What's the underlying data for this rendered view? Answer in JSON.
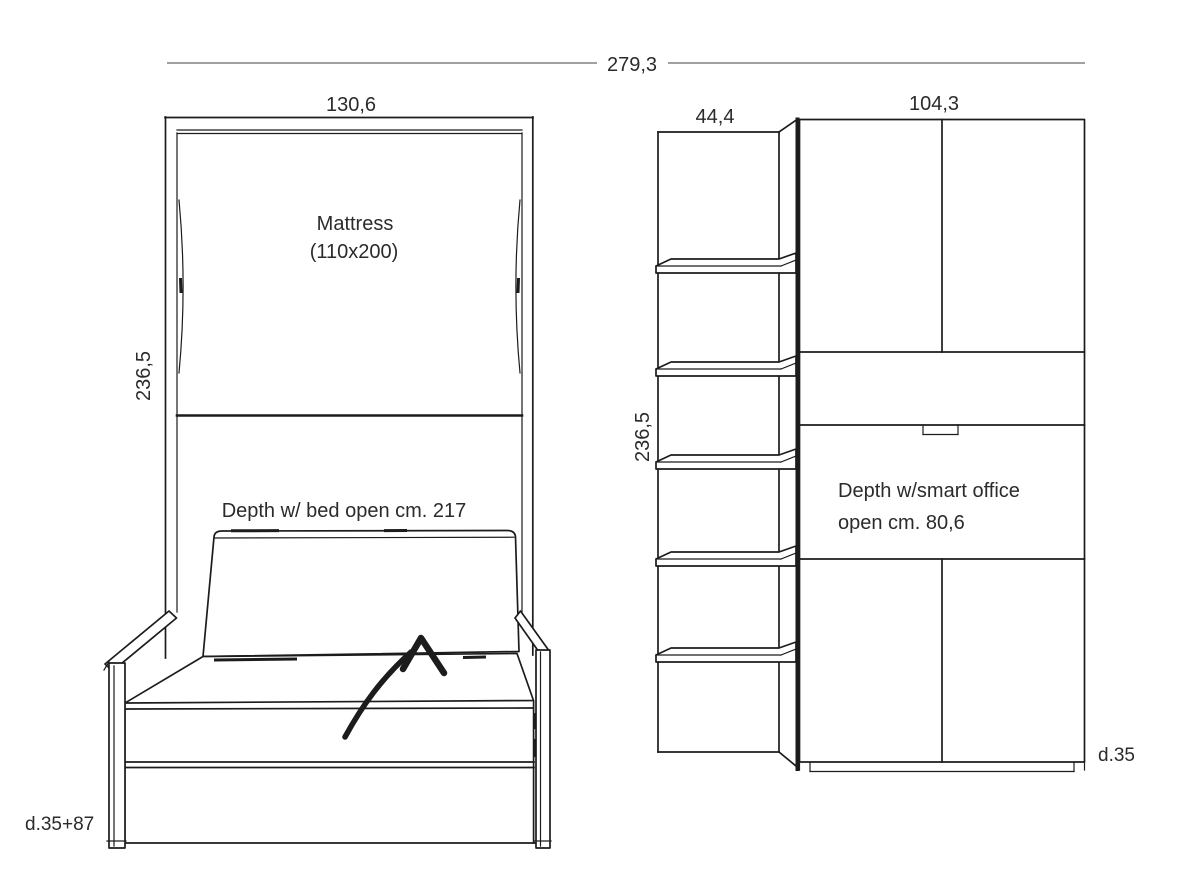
{
  "overall": {
    "width_label": "279,3"
  },
  "bed_unit": {
    "width_label": "130,6",
    "height_label": "236,5",
    "mattress_label_line1": "Mattress",
    "mattress_label_line2": "(110x200)",
    "open_depth_label": "Depth w/ bed open cm. 217",
    "closed_depth_label": "d.35+87"
  },
  "office_unit": {
    "shelf_width_label": "44,4",
    "cabinet_width_label": "104,3",
    "height_label": "236,5",
    "open_depth_label_line1": "Depth w/smart office",
    "open_depth_label_line2": "open cm. 80,6",
    "closed_depth_label": "d.35"
  },
  "colors": {
    "line": "#1c1c1c",
    "dimension_line": "#808080",
    "text": "#2b2b2b",
    "background": "#ffffff"
  }
}
